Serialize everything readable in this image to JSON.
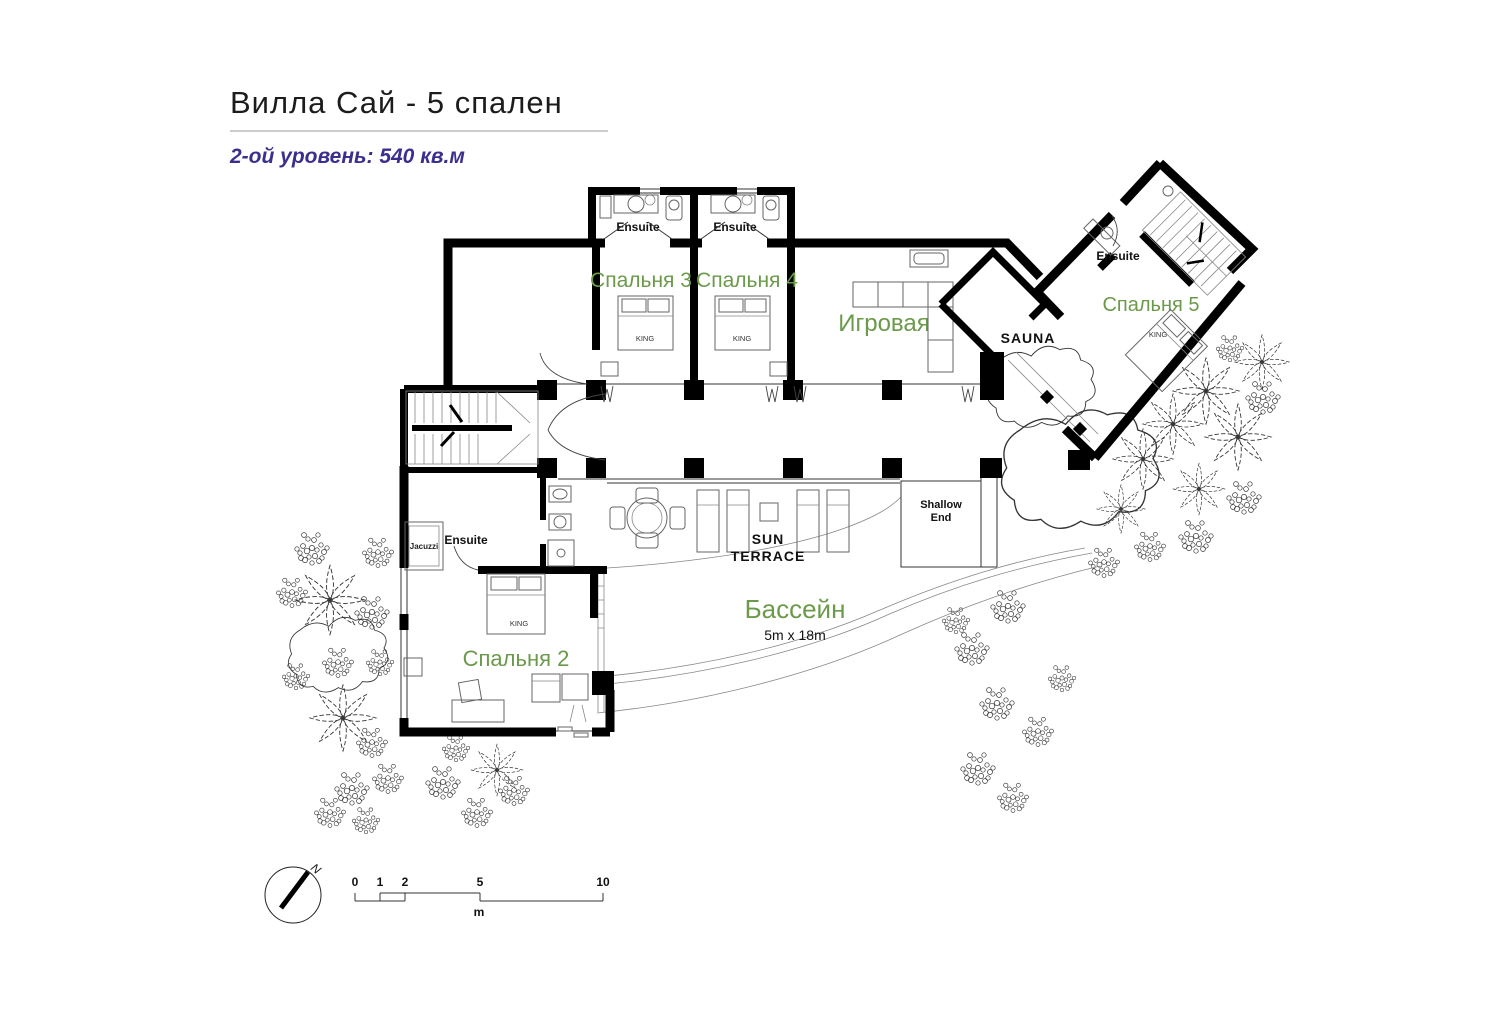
{
  "header": {
    "title": "Вилла Сай  - 5 спален",
    "subtitle": "2-ой уровень:  540 кв.м"
  },
  "colors": {
    "room_label_green": "#6b9a4a",
    "subtitle_purple": "#3b2f8e",
    "wall_black": "#000000"
  },
  "rooms": {
    "bedroom2": "Спальня 2",
    "bedroom3": "Спальня 3",
    "bedroom4": "Спальня 4",
    "bedroom5": "Спальня 5",
    "game_room": "Игровая",
    "sauna": "SAUNA",
    "pool": "Бассейн",
    "pool_size": "5m x 18m",
    "sun_terrace_line1": "SUN",
    "sun_terrace_line2": "TERRACE",
    "shallow_end_line1": "Shallow",
    "shallow_end_line2": "End",
    "ensuite": "Ensuite",
    "jacuzzi": "Jacuzzi",
    "king_bed": "KING"
  },
  "scale_bar": {
    "ticks": [
      "0",
      "1",
      "2",
      "5",
      "10"
    ],
    "unit": "m"
  },
  "compass": {
    "north": "N"
  }
}
